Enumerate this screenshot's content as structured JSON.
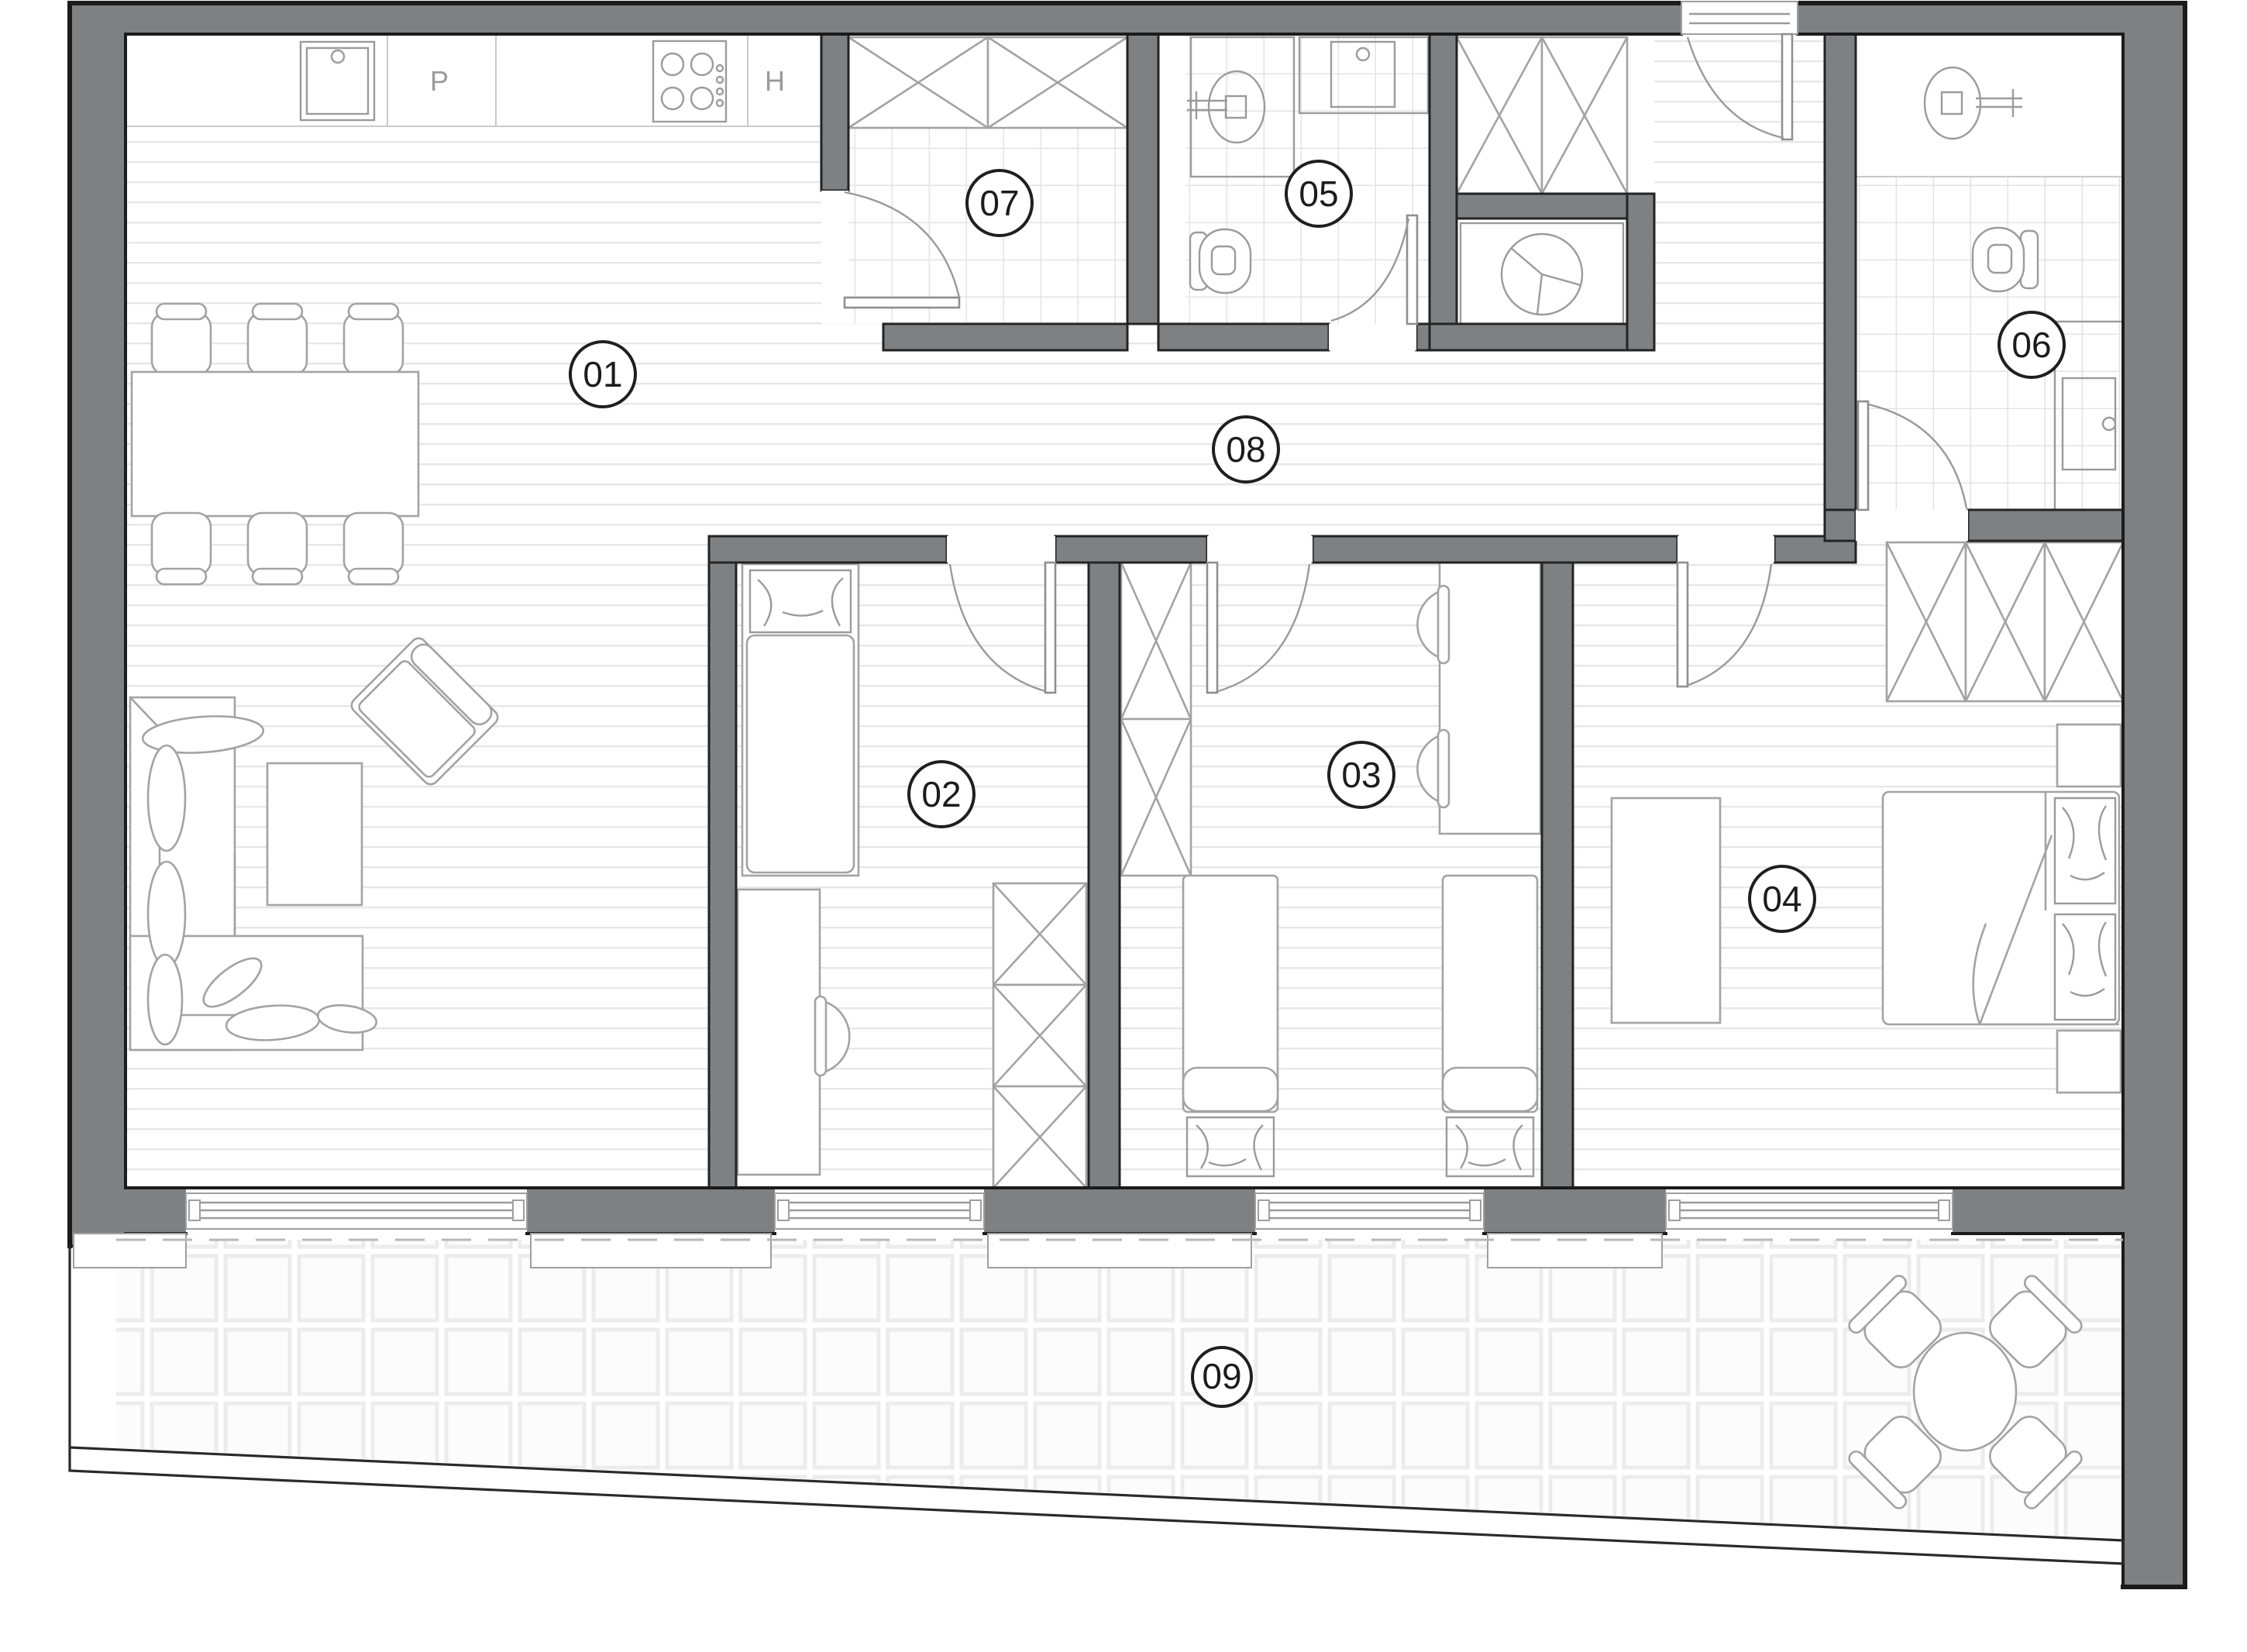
{
  "drawing": {
    "type": "apartment floor plan",
    "wall_color": "#7e8184",
    "outline_color": "#1b1b1b",
    "floor_wood_line_color": "#e7e7e7",
    "floor_tile_line_color": "#e2e2e2"
  },
  "rooms": [
    {
      "number": "01",
      "type": "living-dining-kitchen",
      "floor": "wood",
      "furniture": [
        "kitchen counter",
        "sink",
        "dishwasher",
        "cooktop",
        "oven",
        "dining table",
        "6 chairs",
        "corner sofa",
        "coffee table",
        "armchair"
      ]
    },
    {
      "number": "02",
      "type": "bedroom",
      "floor": "wood",
      "furniture": [
        "single bed",
        "desk",
        "chair",
        "wardrobe"
      ]
    },
    {
      "number": "03",
      "type": "bedroom",
      "floor": "wood",
      "furniture": [
        "two single beds",
        "wardrobe",
        "desk",
        "two chairs"
      ]
    },
    {
      "number": "04",
      "type": "bedroom",
      "floor": "wood",
      "furniture": [
        "double bed",
        "two nightstands",
        "wardrobe",
        "desk"
      ]
    },
    {
      "number": "05",
      "type": "bathroom",
      "floor": "tiles",
      "furniture": [
        "shower",
        "washbasin",
        "toilet"
      ]
    },
    {
      "number": "06",
      "type": "bathroom",
      "floor": "tiles",
      "furniture": [
        "shower",
        "toilet",
        "vanity washbasin"
      ]
    },
    {
      "number": "07",
      "type": "storage",
      "floor": "tiles",
      "furniture": [
        "wardrobe"
      ]
    },
    {
      "number": "08",
      "type": "hallway",
      "floor": "wood",
      "furniture": [
        "entrance door",
        "wardrobe",
        "washing machine"
      ]
    },
    {
      "number": "09",
      "type": "terrace",
      "floor": "tiles",
      "furniture": [
        "round table",
        "4 chairs"
      ]
    }
  ],
  "kitchen_labels": {
    "dishwasher": "P",
    "oven": "H"
  }
}
